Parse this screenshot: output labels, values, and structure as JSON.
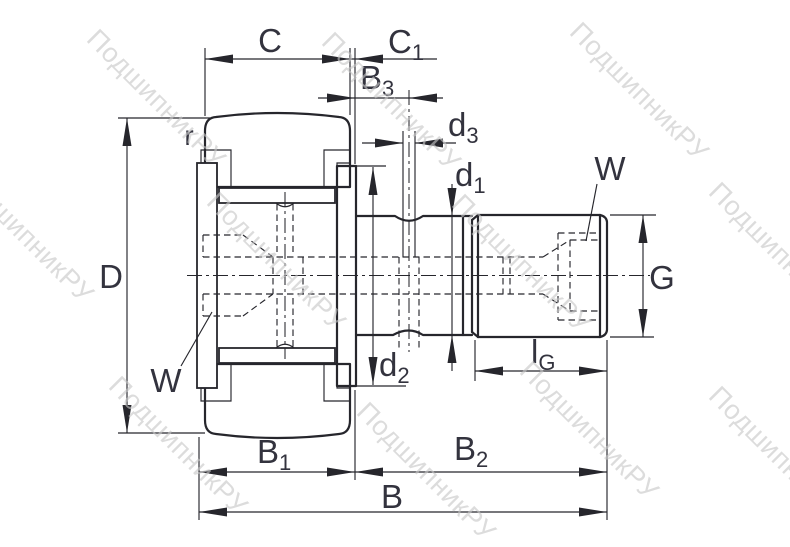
{
  "drawing": {
    "kind": "bearing-cross-section",
    "colors": {
      "background": "#ffffff",
      "line": "#26262c",
      "label": "#33333e",
      "watermark": "#c7c7c7"
    }
  },
  "watermark": {
    "text": "ПодшипникРУ"
  },
  "labels": {
    "C": {
      "base": "C",
      "sub": ""
    },
    "C1": {
      "base": "C",
      "sub": "1"
    },
    "B3": {
      "base": "B",
      "sub": "3"
    },
    "d3": {
      "base": "d",
      "sub": "3"
    },
    "d1": {
      "base": "d",
      "sub": "1"
    },
    "W_top": {
      "base": "W",
      "sub": ""
    },
    "G": {
      "base": "G",
      "sub": ""
    },
    "D": {
      "base": "D",
      "sub": ""
    },
    "r": {
      "base": "r",
      "sub": ""
    },
    "W_bottom": {
      "base": "W",
      "sub": ""
    },
    "d2": {
      "base": "d",
      "sub": "2"
    },
    "lG": {
      "base": "l",
      "sub": "G"
    },
    "B1": {
      "base": "B",
      "sub": "1"
    },
    "B2": {
      "base": "B",
      "sub": "2"
    },
    "B": {
      "base": "B",
      "sub": ""
    }
  }
}
